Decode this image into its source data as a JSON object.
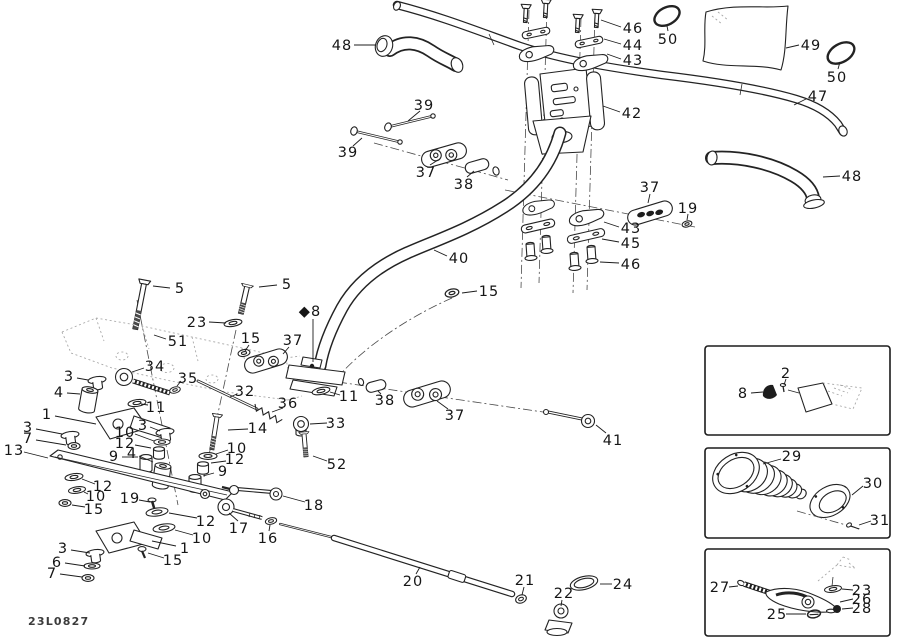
{
  "doc": {
    "code": "23L0827",
    "background": "#ffffff",
    "ink": "#1c1c1c"
  },
  "diagram": {
    "callouts": [
      {
        "label": "48",
        "x": 342,
        "y": 45,
        "line": [
          354,
          45,
          376,
          45
        ]
      },
      {
        "label": "39",
        "x": 424,
        "y": 105,
        "line": [
          420,
          111,
          408,
          121
        ]
      },
      {
        "label": "39",
        "x": 348,
        "y": 152,
        "line": [
          353,
          146,
          362,
          138
        ]
      },
      {
        "label": "37",
        "x": 426,
        "y": 172,
        "line": [
          430,
          165,
          438,
          160
        ]
      },
      {
        "label": "38",
        "x": 464,
        "y": 184,
        "line": [
          467,
          177,
          474,
          171
        ]
      },
      {
        "label": "46",
        "x": 633,
        "y": 28,
        "line": [
          621,
          27,
          601,
          20
        ]
      },
      {
        "label": "44",
        "x": 633,
        "y": 45,
        "line": [
          621,
          44,
          604,
          39
        ]
      },
      {
        "label": "43",
        "x": 633,
        "y": 60,
        "line": [
          621,
          59,
          607,
          54
        ]
      },
      {
        "label": "50",
        "x": 668,
        "y": 39,
        "line": [
          668,
          31,
          667,
          26
        ]
      },
      {
        "label": "49",
        "x": 811,
        "y": 45,
        "line": [
          799,
          45,
          786,
          48
        ]
      },
      {
        "label": "50",
        "x": 837,
        "y": 77,
        "line": [
          838,
          69,
          840,
          62
        ]
      },
      {
        "label": "47",
        "x": 818,
        "y": 96,
        "line": [
          806,
          99,
          794,
          105
        ]
      },
      {
        "label": "42",
        "x": 632,
        "y": 113,
        "line": [
          620,
          112,
          603,
          106
        ]
      },
      {
        "label": "48",
        "x": 852,
        "y": 176,
        "line": [
          840,
          176,
          823,
          177
        ]
      },
      {
        "label": "37",
        "x": 650,
        "y": 187,
        "line": [
          650,
          194,
          648,
          203
        ]
      },
      {
        "label": "19",
        "x": 688,
        "y": 208,
        "line": [
          688,
          214,
          687,
          220
        ]
      },
      {
        "label": "43",
        "x": 631,
        "y": 228,
        "line": [
          619,
          227,
          604,
          222
        ]
      },
      {
        "label": "45",
        "x": 631,
        "y": 243,
        "line": [
          619,
          242,
          602,
          239
        ]
      },
      {
        "label": "46",
        "x": 631,
        "y": 264,
        "line": [
          619,
          263,
          600,
          262
        ]
      },
      {
        "label": "40",
        "x": 459,
        "y": 258,
        "line": [
          447,
          256,
          434,
          250
        ]
      },
      {
        "label": "15",
        "x": 489,
        "y": 291,
        "line": [
          477,
          291,
          462,
          293
        ]
      },
      {
        "label": "5",
        "x": 180,
        "y": 288,
        "line": [
          170,
          288,
          153,
          286
        ]
      },
      {
        "label": "5",
        "x": 287,
        "y": 284,
        "line": [
          277,
          285,
          259,
          287
        ]
      },
      {
        "label": "23",
        "x": 197,
        "y": 322,
        "line": [
          209,
          322,
          226,
          323
        ]
      },
      {
        "label": "◆8",
        "x": 310,
        "y": 311,
        "line": [
          313,
          319,
          313,
          362
        ]
      },
      {
        "label": "15",
        "x": 251,
        "y": 338,
        "line": [
          249,
          345,
          245,
          351
        ]
      },
      {
        "label": "37",
        "x": 293,
        "y": 340,
        "line": [
          289,
          347,
          283,
          354
        ]
      },
      {
        "label": "51",
        "x": 178,
        "y": 341,
        "line": [
          166,
          339,
          154,
          335
        ]
      },
      {
        "label": "34",
        "x": 155,
        "y": 366,
        "line": [
          144,
          368,
          132,
          372
        ]
      },
      {
        "label": "35",
        "x": 188,
        "y": 378,
        "line": [
          181,
          381,
          177,
          386
        ]
      },
      {
        "label": "32",
        "x": 245,
        "y": 391,
        "line": [
          237,
          394,
          230,
          397
        ]
      },
      {
        "label": "36",
        "x": 288,
        "y": 403,
        "line": [
          283,
          408,
          272,
          412
        ]
      },
      {
        "label": "11",
        "x": 349,
        "y": 396,
        "line": [
          340,
          395,
          330,
          392
        ]
      },
      {
        "label": "38",
        "x": 385,
        "y": 400,
        "line": [
          381,
          394,
          378,
          391
        ]
      },
      {
        "label": "37",
        "x": 455,
        "y": 415,
        "line": [
          448,
          409,
          437,
          401
        ]
      },
      {
        "label": "41",
        "x": 613,
        "y": 440,
        "line": [
          606,
          433,
          596,
          425
        ]
      },
      {
        "label": "33",
        "x": 336,
        "y": 423,
        "line": [
          327,
          423,
          310,
          424
        ]
      },
      {
        "label": "14",
        "x": 258,
        "y": 428,
        "line": [
          248,
          429,
          228,
          430
        ]
      },
      {
        "label": "52",
        "x": 337,
        "y": 464,
        "line": [
          327,
          461,
          313,
          456
        ]
      },
      {
        "label": "11",
        "x": 156,
        "y": 407,
        "line": [
          148,
          405,
          141,
          404
        ]
      },
      {
        "label": "3",
        "x": 69,
        "y": 376,
        "line": [
          77,
          378,
          88,
          380
        ]
      },
      {
        "label": "4",
        "x": 59,
        "y": 392,
        "line": [
          67,
          393,
          80,
          394
        ]
      },
      {
        "label": "1",
        "x": 47,
        "y": 414,
        "line": [
          55,
          416,
          96,
          424
        ]
      },
      {
        "label": "3",
        "x": 28,
        "y": 427,
        "line": [
          36,
          429,
          62,
          434
        ]
      },
      {
        "label": "7",
        "x": 28,
        "y": 438,
        "line": [
          36,
          440,
          66,
          445
        ]
      },
      {
        "label": "13",
        "x": 14,
        "y": 450,
        "line": [
          24,
          452,
          48,
          458
        ]
      },
      {
        "label": "3",
        "x": 143,
        "y": 425,
        "line": [
          150,
          427,
          160,
          431
        ]
      },
      {
        "label": "10",
        "x": 125,
        "y": 432,
        "line": [
          135,
          434,
          154,
          441
        ]
      },
      {
        "label": "12",
        "x": 125,
        "y": 443,
        "line": [
          135,
          445,
          151,
          448
        ]
      },
      {
        "label": "9",
        "x": 114,
        "y": 456,
        "line": [
          122,
          457,
          138,
          457
        ]
      },
      {
        "label": "4",
        "x": 132,
        "y": 453,
        "line": [
          139,
          456,
          153,
          462
        ]
      },
      {
        "label": "10",
        "x": 237,
        "y": 448,
        "line": [
          228,
          450,
          216,
          454
        ]
      },
      {
        "label": "12",
        "x": 235,
        "y": 459,
        "line": [
          226,
          461,
          211,
          463
        ]
      },
      {
        "label": "9",
        "x": 223,
        "y": 471,
        "line": [
          214,
          473,
          203,
          476
        ]
      },
      {
        "label": "12",
        "x": 103,
        "y": 486,
        "line": [
          95,
          484,
          82,
          479
        ]
      },
      {
        "label": "10",
        "x": 96,
        "y": 496,
        "line": [
          88,
          494,
          84,
          492
        ]
      },
      {
        "label": "15",
        "x": 94,
        "y": 509,
        "line": [
          85,
          507,
          72,
          505
        ]
      },
      {
        "label": "19",
        "x": 130,
        "y": 498,
        "line": [
          139,
          500,
          150,
          502
        ]
      },
      {
        "label": "12",
        "x": 206,
        "y": 521,
        "line": [
          197,
          518,
          169,
          513
        ]
      },
      {
        "label": "10",
        "x": 202,
        "y": 538,
        "line": [
          193,
          535,
          175,
          530
        ]
      },
      {
        "label": "1",
        "x": 185,
        "y": 548,
        "line": [
          176,
          546,
          152,
          541
        ]
      },
      {
        "label": "15",
        "x": 173,
        "y": 560,
        "line": [
          164,
          558,
          148,
          553
        ]
      },
      {
        "label": "17",
        "x": 239,
        "y": 528,
        "line": [
          238,
          521,
          229,
          513
        ]
      },
      {
        "label": "16",
        "x": 268,
        "y": 538,
        "line": [
          269,
          531,
          270,
          525
        ]
      },
      {
        "label": "18",
        "x": 314,
        "y": 505,
        "line": [
          305,
          502,
          283,
          496
        ]
      },
      {
        "label": "3",
        "x": 63,
        "y": 548,
        "line": [
          71,
          550,
          90,
          553
        ]
      },
      {
        "label": "6",
        "x": 57,
        "y": 562,
        "line": [
          65,
          563,
          85,
          566
        ]
      },
      {
        "label": "7",
        "x": 52,
        "y": 573,
        "line": [
          60,
          574,
          82,
          577
        ]
      },
      {
        "label": "20",
        "x": 413,
        "y": 581,
        "line": [
          416,
          574,
          420,
          567
        ]
      },
      {
        "label": "21",
        "x": 525,
        "y": 580,
        "line": [
          524,
          587,
          522,
          595
        ]
      },
      {
        "label": "22",
        "x": 564,
        "y": 593,
        "line": [
          562,
          600,
          561,
          606
        ]
      },
      {
        "label": "24",
        "x": 623,
        "y": 584,
        "line": [
          612,
          584,
          600,
          584
        ]
      },
      {
        "label": "2",
        "x": 786,
        "y": 373,
        "line": [
          786,
          379,
          784,
          385
        ]
      },
      {
        "label": "8",
        "x": 743,
        "y": 393,
        "line": [
          751,
          393,
          763,
          392
        ]
      },
      {
        "label": "29",
        "x": 792,
        "y": 456,
        "line": [
          781,
          459,
          763,
          464
        ]
      },
      {
        "label": "30",
        "x": 873,
        "y": 483,
        "line": [
          863,
          486,
          852,
          495
        ]
      },
      {
        "label": "31",
        "x": 880,
        "y": 520,
        "line": [
          871,
          521,
          859,
          525
        ]
      },
      {
        "label": "27",
        "x": 720,
        "y": 587,
        "line": [
          729,
          587,
          738,
          586
        ]
      },
      {
        "label": "23",
        "x": 862,
        "y": 590,
        "line": [
          853,
          590,
          842,
          589
        ]
      },
      {
        "label": "26",
        "x": 862,
        "y": 599,
        "line": [
          853,
          599,
          840,
          602
        ]
      },
      {
        "label": "28",
        "x": 862,
        "y": 608,
        "line": [
          853,
          608,
          842,
          609
        ]
      },
      {
        "label": "25",
        "x": 777,
        "y": 614,
        "line": [
          786,
          614,
          806,
          614
        ]
      }
    ]
  }
}
